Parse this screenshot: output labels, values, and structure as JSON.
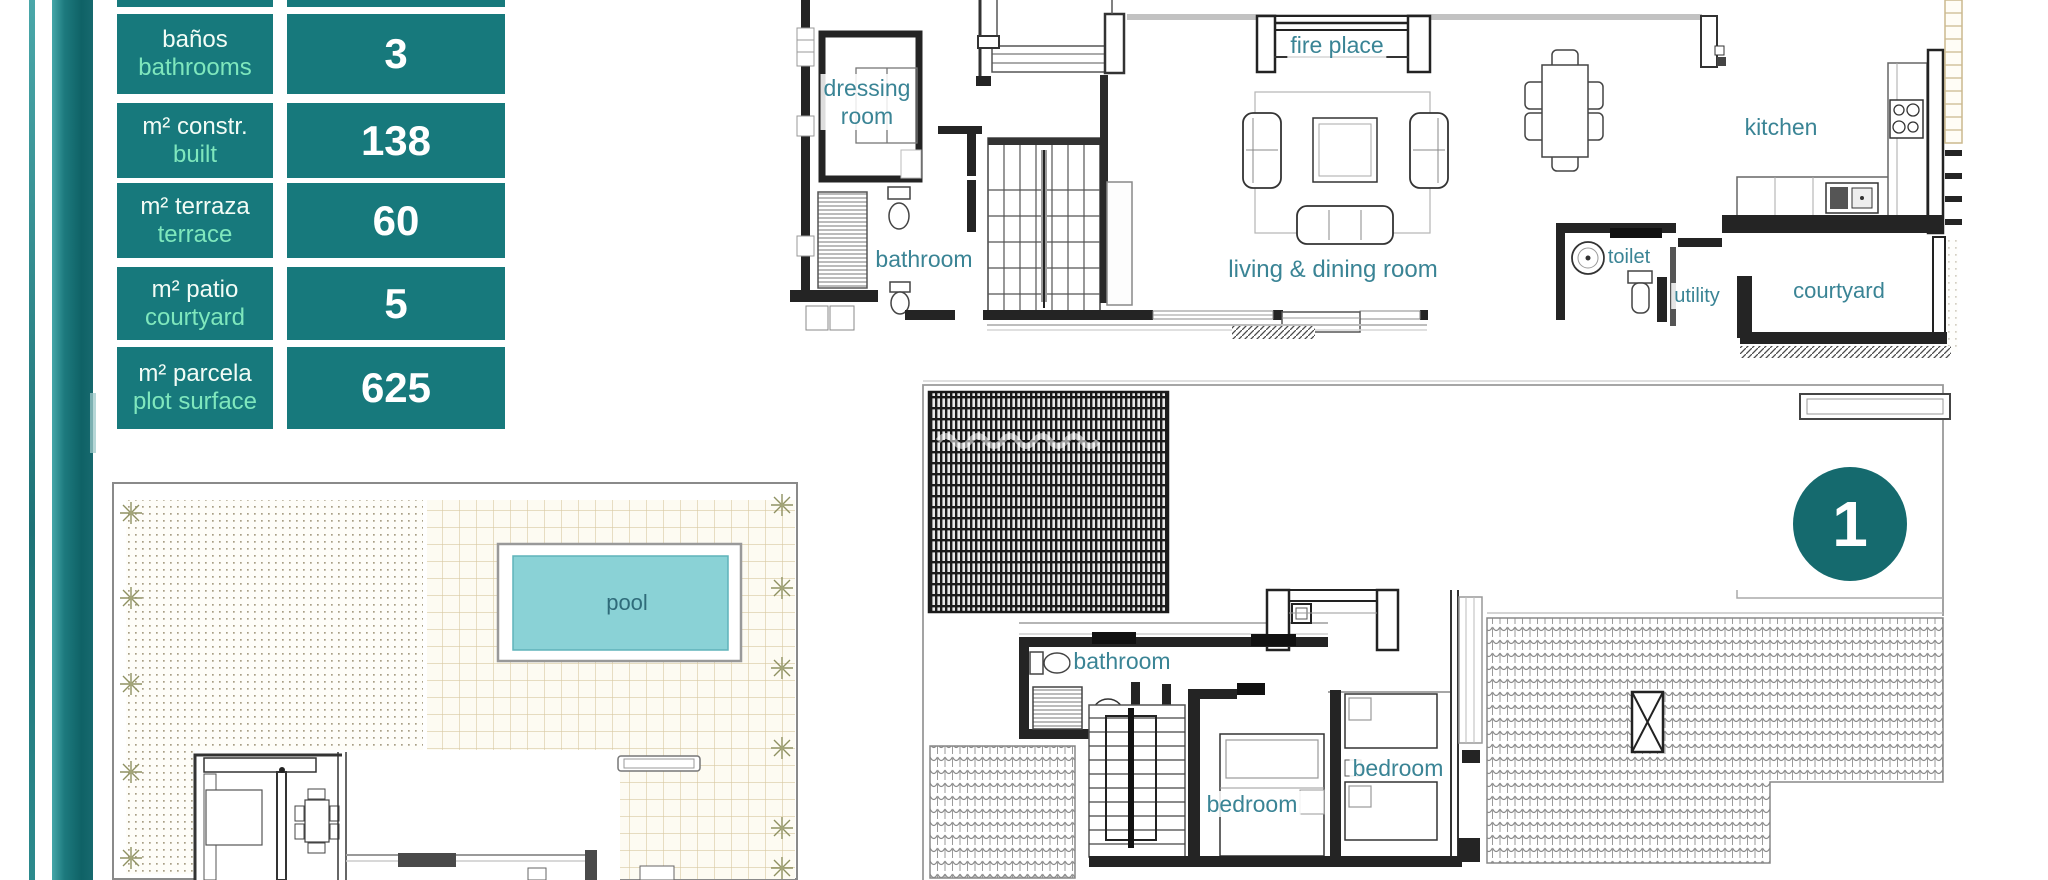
{
  "palette": {
    "teal_cell": "#17797c",
    "teal_bar_dark": "#0f6266",
    "teal_bar_light": "#45a7a9",
    "badge_teal": "#156a6e",
    "label_es_color": "#f2fcf6",
    "label_en_color": "#7fe7bd",
    "value_color": "#ffffff",
    "room_label_color": "#3a8495",
    "pool_fill": "#8ad2d6",
    "tan_grid_line": "#d9c9a2",
    "wall_color": "#242424"
  },
  "stats_table": {
    "rows": [
      {
        "label_es": "baños",
        "label_en": "bathrooms",
        "value": "3"
      },
      {
        "label_es": "m² constr.",
        "label_en": "built",
        "value": "138"
      },
      {
        "label_es": "m² terraza",
        "label_en": "terrace",
        "value": "60"
      },
      {
        "label_es": "m² patio",
        "label_en": "courtyard",
        "value": "5"
      },
      {
        "label_es": "m² parcela",
        "label_en": "plot surface",
        "value": "625"
      }
    ]
  },
  "ground_floor": {
    "labels": {
      "dressing_line1": "dressing",
      "dressing_line2": "room",
      "bathroom": "bathroom",
      "fire_place": "fire place",
      "living_dining": "living & dining room",
      "toilet": "toilet",
      "utility": "utility",
      "kitchen": "kitchen",
      "courtyard": "courtyard"
    }
  },
  "site_plan": {
    "labels": {
      "pool": "pool"
    }
  },
  "first_floor": {
    "badge": "1",
    "labels": {
      "bathroom": "bathroom",
      "bedroom_left": "bedroom",
      "bedroom_right": "bedroom"
    }
  }
}
